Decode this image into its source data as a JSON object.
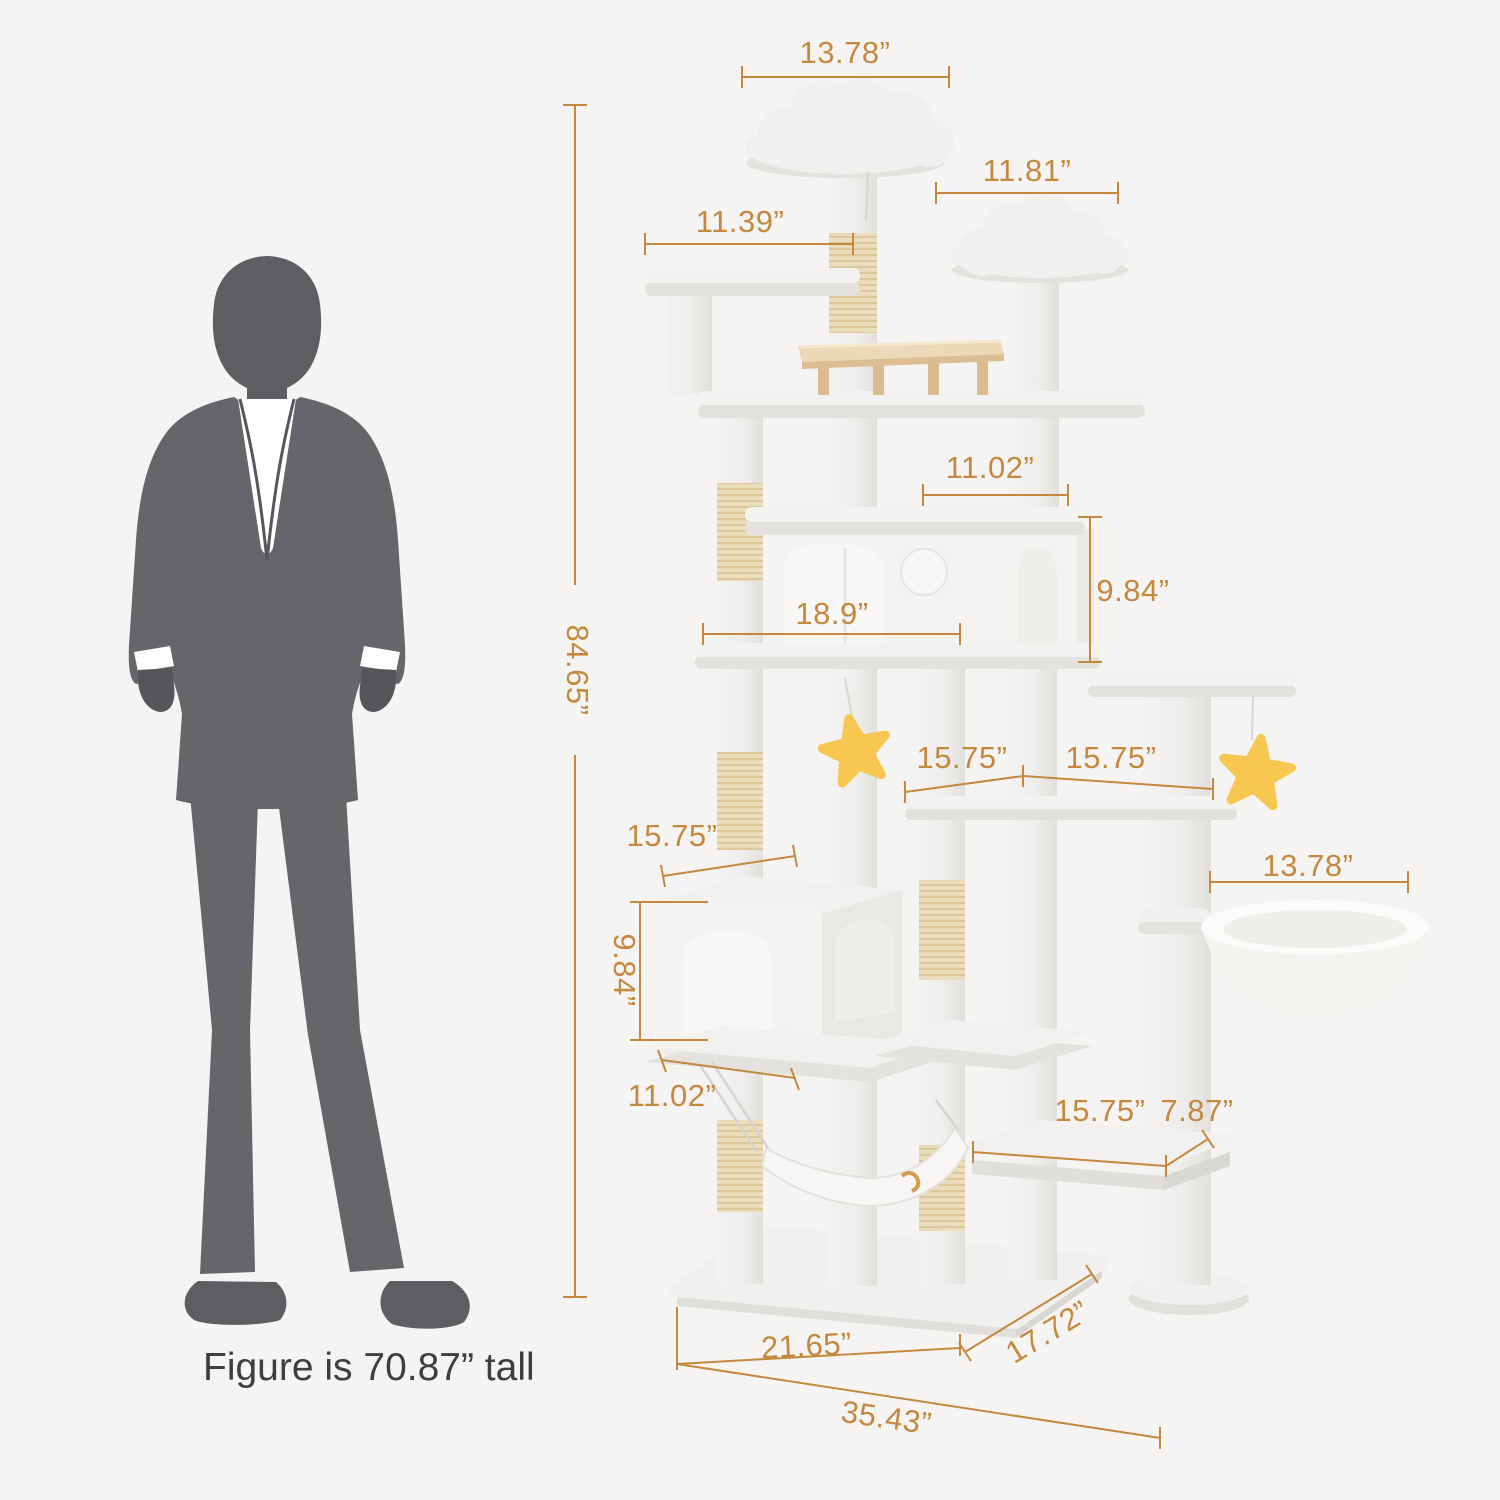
{
  "colors": {
    "background": "#F5F4F2",
    "accent": "#C4883F",
    "figure_silhouette": "#66666A",
    "caption_text": "#3E3E3E",
    "sisal": "#EBDCBC",
    "wood_perch": "#EDD9B8",
    "star_toy": "#F8C751",
    "moon_toy": "#6C93DB"
  },
  "figure": {
    "caption": "Figure is 70.87”  tall"
  },
  "dimensions": {
    "top_perch_width": "13.78”",
    "second_perch_width": "11.81”",
    "upper_left_platform_width": "11.39”",
    "total_height": "84.65”",
    "upper_condo_depth": "11.02”",
    "upper_condo_height": "9.84”",
    "upper_condo_width": "18.9”",
    "middle_shelf_left_width": "15.75”",
    "middle_shelf_right_width": "15.75”",
    "lower_condo_top_width": "15.75”",
    "lower_condo_height": "9.84”",
    "lower_condo_bottom_width": "11.02”",
    "hanging_basket_width": "13.78”",
    "bottom_platform_width": "15.75”",
    "bottom_platform_depth": "7.87”",
    "base_front_width": "21.65”",
    "base_side_depth": "17.72”",
    "base_total_width": "35.43”"
  }
}
